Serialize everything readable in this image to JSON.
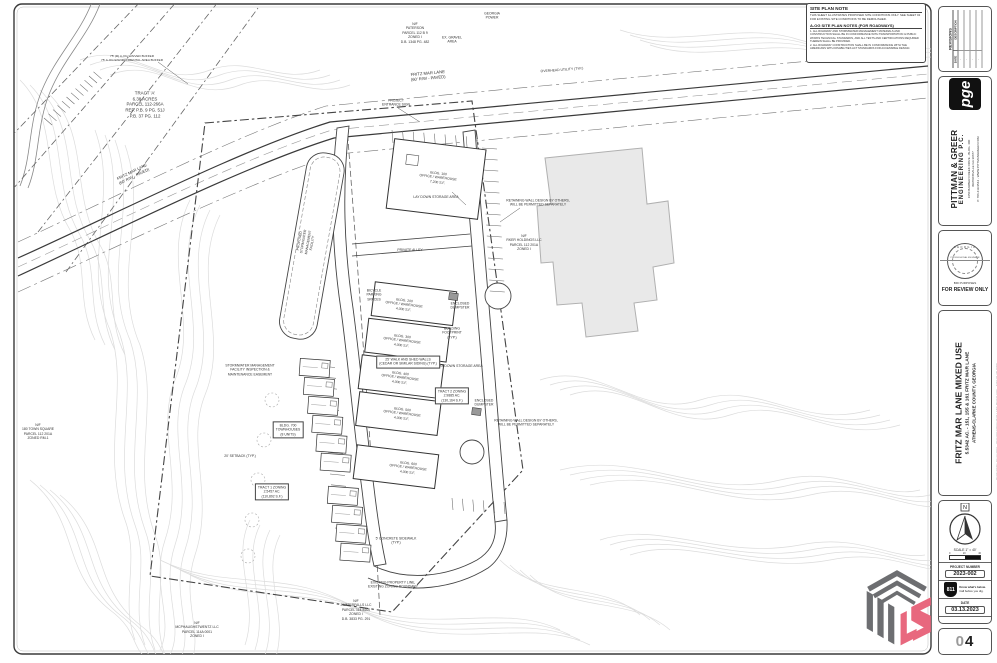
{
  "notes_box": {
    "title": "SITE PLAN NOTE",
    "body": "THIS SHEET ILLUSTRATES PROPOSED SITE CONDITIONS ONLY. SEE SHEET 02 FOR EXISTING SITE CONDITIONS TO BE DEMOLISHED.",
    "subtitle": "A-OG SITE PLAN NOTES (FOR ROADWAYS)",
    "items": [
      "1.  ALL ROADWAY AND STORMWATER MANAGEMENT MATERIALS AND CONSTRUCTION SHALL BE IN CONFORMANCE WITH TRANSPORTATION & PUBLIC WORKS TECHNICAL STANDARDS, AND ALL TESTS AND CERTIFICATIONS REQUIRED THEREIN SHALL BE PROVIDED.",
      "2.  ALL ROADWAY CONSTRUCTION SHALL BE IN CONFORMANCE WITH THE AMERICANS WITH DISABILITIES ACT STANDARDS FOR ACCESSIBLE DESIGN."
    ]
  },
  "plan": {
    "labels": [
      {
        "t": "N/F\nPATERSON\nPARCEL 112 B 9\nZONED I\nD.B. 1348 PG. 482",
        "x": 415,
        "y": 33
      },
      {
        "t": "TRACT 'A'\n6.38 ACRES\nPARCEL 112-266A\nREF. P.B. 9 PG. 51J\nP.B. 37 PG. 112",
        "x": 145,
        "y": 105,
        "fs": 4.4
      },
      {
        "t": "FRITZ MAR LANE\n(60' R/W - PAVED)",
        "x": 428,
        "y": 76,
        "r": -5,
        "fs": 4.2
      },
      {
        "t": "FRITZ MAR LANE\n(60' R/W - PAVED)",
        "x": 133,
        "y": 174,
        "r": -26,
        "fs": 4
      },
      {
        "t": "75' (R) A-OG WAIVED BUFFER\n75' A-OG ENVIRONMENTAL AREA BUFFER",
        "x": 132,
        "y": 58,
        "fs": 3.1
      },
      {
        "t": "PROJECT\nENTRANCE SIGN",
        "x": 396,
        "y": 103
      },
      {
        "t": "N/F\nRKER HOLDINGS LLC\nPARCEL 112 201A\nZONED I",
        "x": 524,
        "y": 243
      },
      {
        "t": "BLDG. 100\nOFFICE / WAREHOUSE\n7,200 S.F.",
        "x": 438,
        "y": 178,
        "r": 7
      },
      {
        "t": "BLDG. 200\nOFFICE / WAREHOUSE\n4,000 S.F.",
        "x": 404,
        "y": 305,
        "r": 7
      },
      {
        "t": "BLDG. 300\nOFFICE / WAREHOUSE\n4,000 S.F.",
        "x": 402,
        "y": 341,
        "r": 7
      },
      {
        "t": "BLDG. 400\nOFFICE / WAREHOUSE\n4,000 S.F.",
        "x": 400,
        "y": 378,
        "r": 7
      },
      {
        "t": "BLDG. 500\nOFFICE / WAREHOUSE\n4,000 S.F.",
        "x": 402,
        "y": 414,
        "r": 7
      },
      {
        "t": "BLDG. 600\nOFFICE / WAREHOUSE\n4,000 S.F.",
        "x": 408,
        "y": 468,
        "r": 7
      },
      {
        "t": "BLDG. 700\nTOWNHOUSES\n(8 UNITS)",
        "x": 288,
        "y": 430,
        "box": true
      },
      {
        "t": "TRACT 1 ZONING\n2.5457 AC.\n(110,892 S.F.)",
        "x": 272,
        "y": 492,
        "box": true
      },
      {
        "t": "TRACT 2 ZONING\n2.9885 AC.\n(130,164 S.F.)",
        "x": 452,
        "y": 396,
        "box": true
      },
      {
        "t": "LAY DOWN STORAGE AREA",
        "x": 436,
        "y": 197
      },
      {
        "t": "LAY DOWN STORAGE AREA",
        "x": 460,
        "y": 366
      },
      {
        "t": "ENCLOSED\nDUMPSTER",
        "x": 460,
        "y": 306
      },
      {
        "t": "ENCLOSED\nDUMPSTER",
        "x": 484,
        "y": 403
      },
      {
        "t": "BUILDING\nFOOTPRINT\n(TYP.)",
        "x": 452,
        "y": 333
      },
      {
        "t": "PROPOSED\nSTORMWATER\nMANAGEMENT\nFACILITY",
        "x": 306,
        "y": 242,
        "r": -80
      },
      {
        "t": "PRIVATE ALLEY",
        "x": 410,
        "y": 250
      },
      {
        "t": "N/F\n180 TOWN SQUARE\nPARCEL 112 201A\nZONED RM-1",
        "x": 38,
        "y": 432
      },
      {
        "t": "N/F\nJWATERFALLS LLC\nPARCEL 114-5200\nZONED I\nD.B. 3833 PG. 291",
        "x": 356,
        "y": 610
      },
      {
        "t": "N/F\nMCPHAUGHSTWENTZ LLC\nPARCEL 114A 0001\nZONED I",
        "x": 197,
        "y": 630
      },
      {
        "t": "EXISTING PROPERTY LINE,\nEXISTING ZONING BOUNDARY",
        "x": 393,
        "y": 585
      },
      {
        "t": "STORMWATER MANAGEMENT\nFACILITY INSPECTION &\nMAINTENANCE EASEMENT",
        "x": 250,
        "y": 370
      },
      {
        "t": "20' SETBACK (TYP.)",
        "x": 240,
        "y": 456
      },
      {
        "t": "BICYCLE\nPARKING\nSPACES",
        "x": 374,
        "y": 295
      },
      {
        "t": "25' WALK AND SHED WALLS\n(CEDAR OR SIMILAR SIDING) (TYP.)",
        "x": 408,
        "y": 362,
        "box": true
      },
      {
        "t": "RETAINING WALL DESIGN BY OTHERS,\nWILL BE PERMITTED SEPARATELY",
        "x": 538,
        "y": 203
      },
      {
        "t": "RETAINING WALL DESIGN BY OTHERS,\nWILL BE PERMITTED SEPARATELY",
        "x": 526,
        "y": 423
      },
      {
        "t": "5' CONCRETE SIDEWALK\n(TYP.)",
        "x": 396,
        "y": 541
      },
      {
        "t": "OVERHEAD UTILITY (TYP.)",
        "x": 562,
        "y": 70,
        "r": -4
      },
      {
        "t": "EX. GRAVEL\nAREA",
        "x": 452,
        "y": 40
      },
      {
        "t": "GEORGIA\nPOWER",
        "x": 492,
        "y": 16
      }
    ]
  },
  "titleblock": {
    "revisions": {
      "title": "REVISIONS",
      "date": "DATE",
      "description": "DESCRIPTION"
    },
    "firm": {
      "logo": "pge",
      "name1": "PITTMAN & GREER",
      "name2": "ENGINEERING P.C.",
      "addr1": "1650 BARBER CREEK DRIVE - BLDG. 400",
      "addr2": "WATKINSVILLE GA 30677",
      "addr3": "P. 706.419.9544 - WWW.PITTMANGREER.COM"
    },
    "seal": {
      "state": "GEORGIA",
      "center": "PROFESSIONAL ENGINEER",
      "purpose": "BID PURPOSES",
      "review": "FOR REVIEW ONLY"
    },
    "project": {
      "title": "FRITZ MAR LANE MIXED USE",
      "sub1": "5.5342 AC. - 151, 155 & 161 FRITZ MAR LANE",
      "sub2": "ATHENS-CLARKE COUNTY, GEORGIA"
    },
    "north_letter": "N",
    "scale_label": "SCALE 1\" = 40'",
    "scale_tick_0": "0",
    "scale_tick_1": "20",
    "scale_tick_2": "40",
    "project_number_label": "PROJECT NUMBER",
    "project_number": "2023-002",
    "call811": {
      "number": "811",
      "line1": "Know what's below.",
      "line2": "Call before you dig."
    },
    "date_label": "DATE",
    "date_value": "03.13.2023",
    "sheet_title": "SITE PLAN",
    "sheet_number": "04",
    "plot_stamp": "PLOT DATE: 03.13.2023 - 2023-002 FRITZ MAR LANE MIXED USE - SITE PLAN.DWG"
  },
  "watermark": {
    "gray": "#6d6e71",
    "pink": "#e8687e"
  }
}
